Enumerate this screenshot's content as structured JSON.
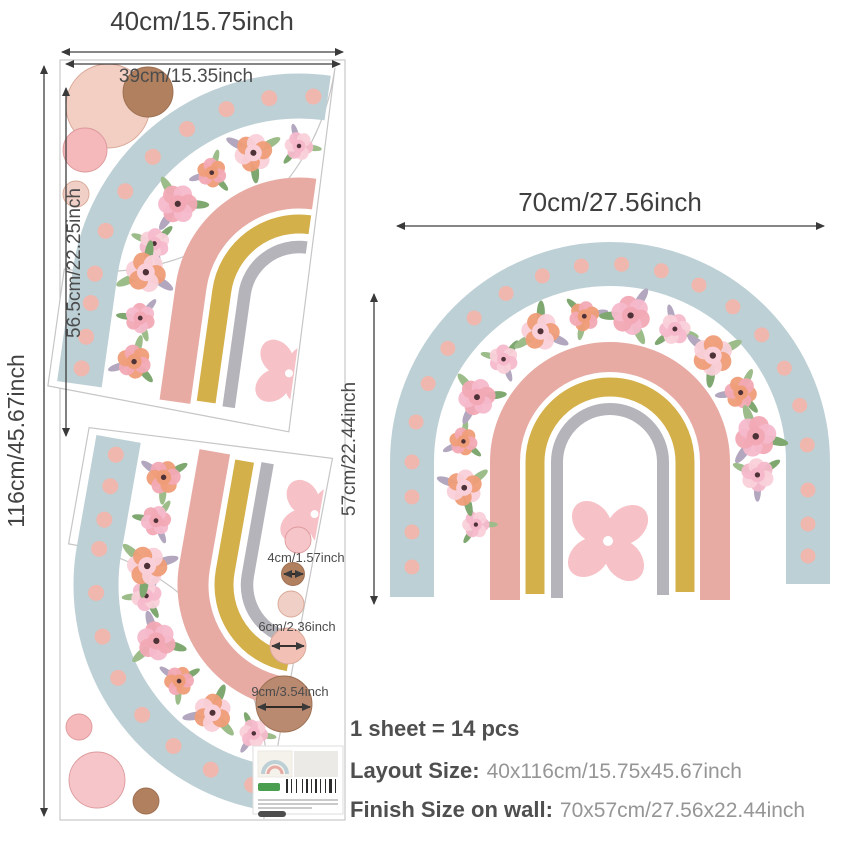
{
  "labels": {
    "sheet_width": "40cm/15.75inch",
    "sheet_inner_width": "39cm/15.35inch",
    "sheet_height": "116cm/45.67inch",
    "piece_height": "56.5cm/22.25inch",
    "wall_width": "70cm/27.56inch",
    "wall_height": "57cm/22.44inch",
    "circle_small": "4cm/1.57inch",
    "circle_medium": "6cm/2.36inch",
    "circle_large": "9cm/3.54inch"
  },
  "summary": {
    "pieces": "1 sheet = 14 pcs",
    "layout_label": "Layout Size:",
    "layout_value": "40x116cm/15.75x45.67inch",
    "finish_label": "Finish Size on wall:",
    "finish_value": "70x57cm/27.56x22.44inch"
  },
  "colors": {
    "band_blue": "#bdd0d6",
    "band_pink": "#e7aba4",
    "band_yellow": "#d4b04b",
    "band_gray": "#b5b4bb",
    "dot": "#efb7ad",
    "center_flower": "#f6c1c7",
    "petals": [
      "#f6b9cc",
      "#f9d0d9",
      "#ef9d78",
      "#f2a9b5"
    ],
    "petal_center": "#4f3237",
    "leaves": [
      "#9cbd8a",
      "#7fa871",
      "#b3a7bf"
    ],
    "outline": "#c6c6c6",
    "arrow": "#3d3d3d",
    "circle_pale": "#f2cec3",
    "circle_pink": "#f5b9bb",
    "circle_light": "#f6c5c9",
    "circle_brown": "#b0805f",
    "circle_brown_big": "#b98970",
    "circle_pale2": "#f0d0c6",
    "circle_rose": "#f2c0b4",
    "logo_green": "#4a9e4f"
  }
}
